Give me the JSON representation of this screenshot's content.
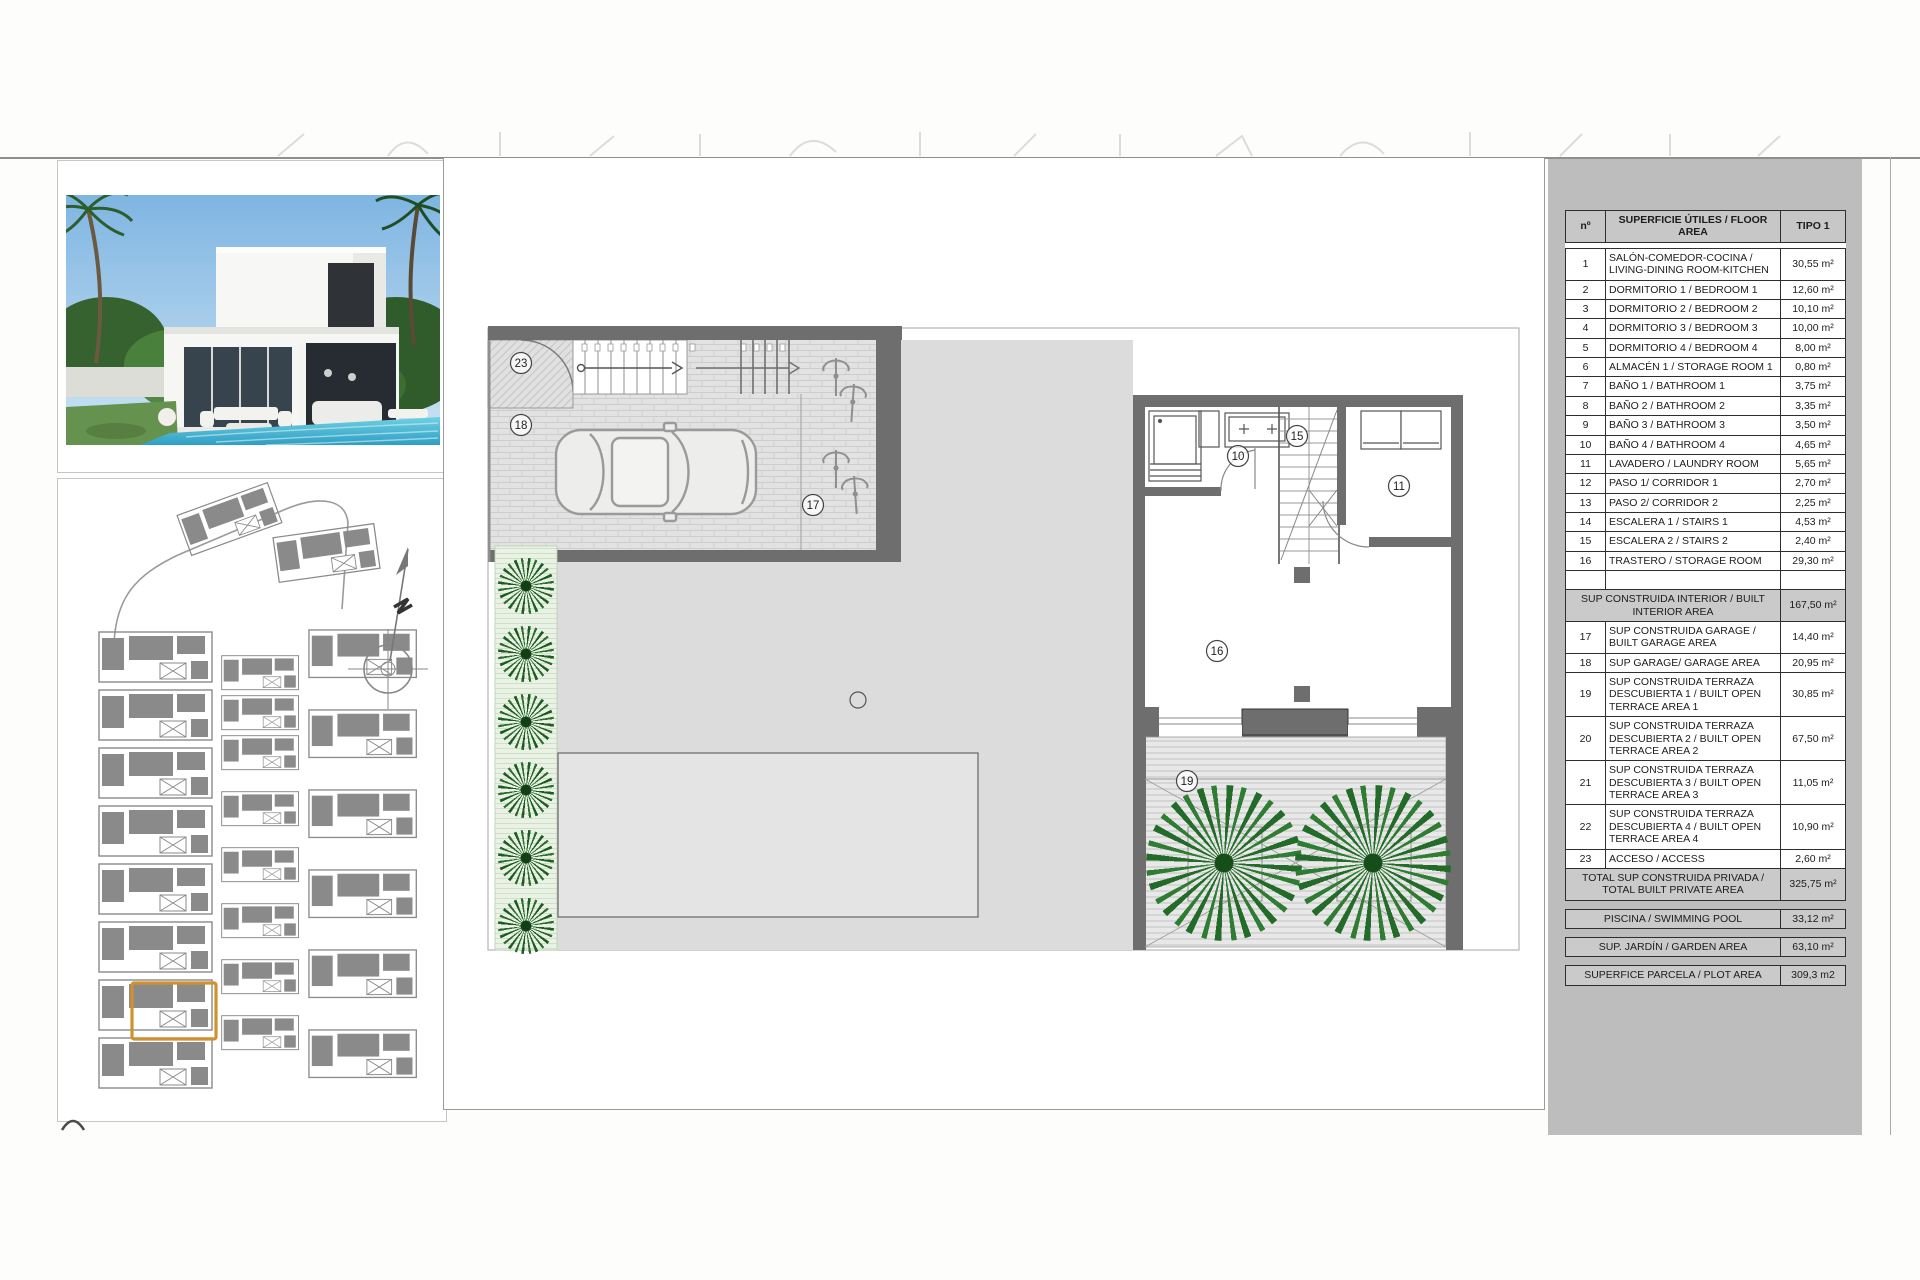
{
  "plan": {
    "labels": {
      "n23": "23",
      "n18": "18",
      "n17": "17",
      "n10": "10",
      "n15": "15",
      "n11": "11",
      "n16": "16",
      "n19": "19"
    }
  },
  "areas_table": {
    "header": {
      "num": "nº",
      "label": "SUPERFICIE ÚTILES / FLOOR AREA",
      "type": "TIPO 1"
    },
    "rooms": [
      {
        "n": "1",
        "label": "SALÓN-COMEDOR-COCINA / LIVING-DINING ROOM-KITCHEN",
        "value": "30,55 m²"
      },
      {
        "n": "2",
        "label": "DORMITORIO 1 / BEDROOM 1",
        "value": "12,60 m²"
      },
      {
        "n": "3",
        "label": "DORMITORIO 2 / BEDROOM 2",
        "value": "10,10 m²"
      },
      {
        "n": "4",
        "label": "DORMITORIO 3 / BEDROOM 3",
        "value": "10,00 m²"
      },
      {
        "n": "5",
        "label": "DORMITORIO 4 / BEDROOM 4",
        "value": "8,00 m²"
      },
      {
        "n": "6",
        "label": "ALMACÉN 1 / STORAGE ROOM 1",
        "value": "0,80 m²"
      },
      {
        "n": "7",
        "label": "BAÑO 1 / BATHROOM 1",
        "value": "3,75 m²"
      },
      {
        "n": "8",
        "label": "BAÑO 2 / BATHROOM 2",
        "value": "3,35 m²"
      },
      {
        "n": "9",
        "label": "BAÑO 3 / BATHROOM 3",
        "value": "3,50 m²"
      },
      {
        "n": "10",
        "label": "BAÑO 4 / BATHROOM 4",
        "value": "4,65 m²"
      },
      {
        "n": "11",
        "label": "LAVADERO / LAUNDRY ROOM",
        "value": "5,65 m²"
      },
      {
        "n": "12",
        "label": "PASO 1/ CORRIDOR 1",
        "value": "2,70 m²"
      },
      {
        "n": "13",
        "label": "PASO 2/ CORRIDOR 2",
        "value": "2,25 m²"
      },
      {
        "n": "14",
        "label": "ESCALERA 1 / STAIRS 1",
        "value": "4,53 m²"
      },
      {
        "n": "15",
        "label": "ESCALERA 2 / STAIRS 2",
        "value": "2,40 m²"
      },
      {
        "n": "16",
        "label": "TRASTERO / STORAGE ROOM",
        "value": "29,30 m²"
      }
    ],
    "interior_total": {
      "label": "SUP CONSTRUIDA INTERIOR / BUILT INTERIOR AREA",
      "value": "167,50 m²"
    },
    "outdoor": [
      {
        "n": "17",
        "label": "SUP CONSTRUIDA GARAGE / BUILT GARAGE AREA",
        "value": "14,40 m²"
      },
      {
        "n": "18",
        "label": "SUP GARAGE/ GARAGE AREA",
        "value": "20,95 m²"
      },
      {
        "n": "19",
        "label": "SUP CONSTRUIDA TERRAZA DESCUBIERTA 1 / BUILT OPEN TERRACE AREA 1",
        "value": "30,85 m²"
      },
      {
        "n": "20",
        "label": "SUP CONSTRUIDA TERRAZA DESCUBIERTA 2 / BUILT OPEN TERRACE AREA 2",
        "value": "67,50 m²"
      },
      {
        "n": "21",
        "label": "SUP CONSTRUIDA TERRAZA DESCUBIERTA 3 / BUILT OPEN TERRACE AREA 3",
        "value": "11,05 m²"
      },
      {
        "n": "22",
        "label": "SUP CONSTRUIDA TERRAZA DESCUBIERTA 4 / BUILT OPEN TERRACE AREA 4",
        "value": "10,90 m²"
      },
      {
        "n": "23",
        "label": "ACCESO / ACCESS",
        "value": "2,60 m²"
      }
    ],
    "total": {
      "label": "TOTAL SUP CONSTRUIDA PRIVADA / TOTAL BUILT PRIVATE AREA",
      "value": "325,75 m²"
    },
    "extras": [
      {
        "label": "PISCINA / SWIMMING POOL",
        "value": "33,12 m²"
      },
      {
        "label": "SUP. JARDÍN / GARDEN AREA",
        "value": "63,10 m²"
      },
      {
        "label": "SUPERFICE PARCELA / PLOT AREA",
        "value": "309,3 m2"
      }
    ]
  },
  "colors": {
    "highlight_orange": "#d0922f",
    "wall_gray": "#6e6e6e",
    "terrace_gray": "#dcdcdc",
    "panel_gray": "#bdbdbd",
    "hedge_green": "#1b5e20",
    "palm_green": "#2e7d32",
    "pool_blue": "#3fb0cd"
  }
}
